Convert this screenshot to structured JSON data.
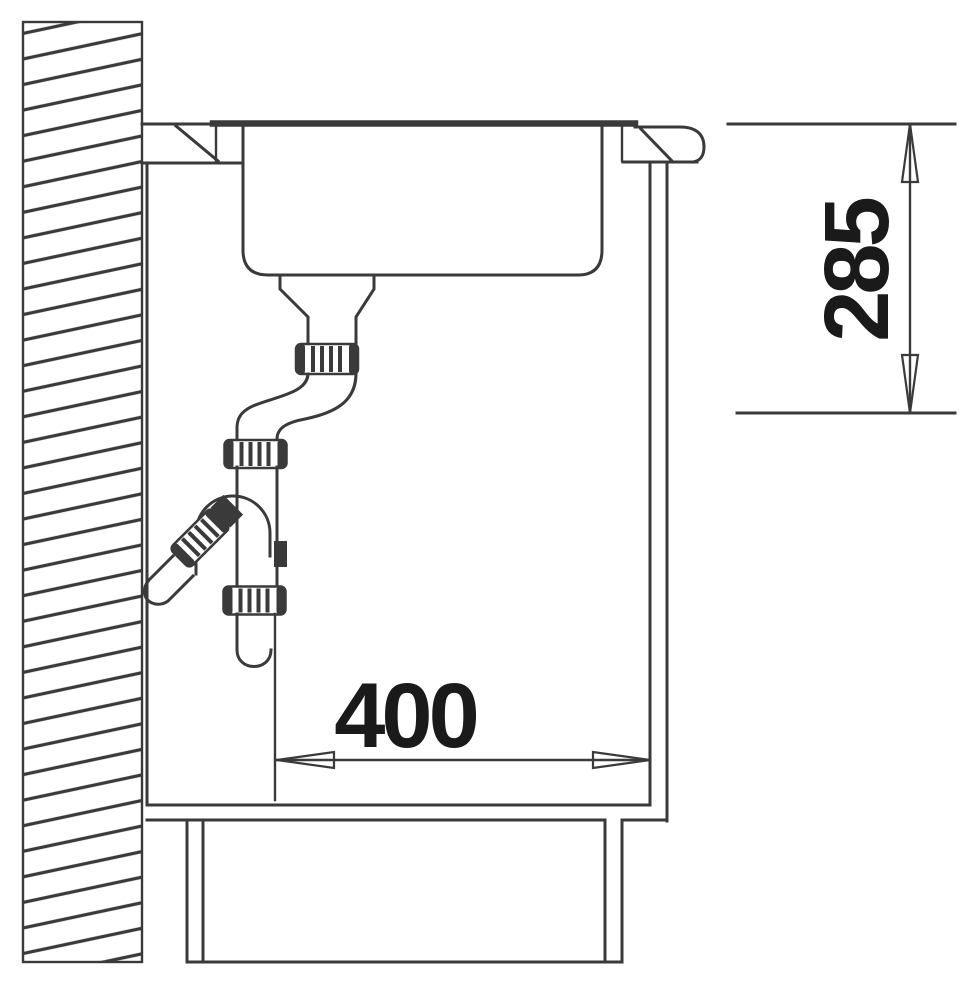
{
  "drawing": {
    "type": "technical-section-drawing",
    "colors": {
      "background": "#ffffff",
      "line": "#3a3a3a",
      "label": "#1a1a1a"
    },
    "dimensions": {
      "vertical": "285",
      "horizontal": "400"
    }
  }
}
